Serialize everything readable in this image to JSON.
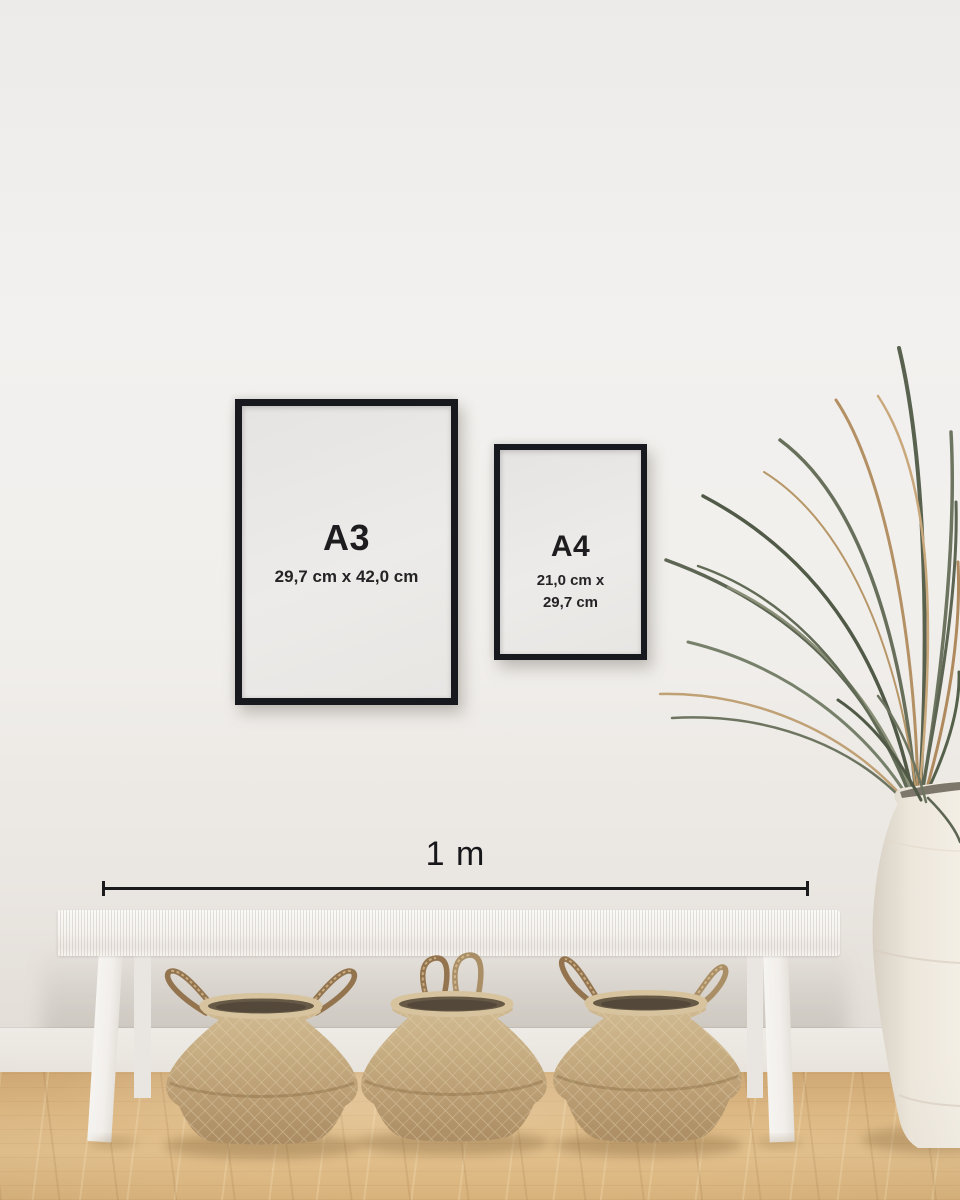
{
  "frames": {
    "a3": {
      "label": "A3",
      "dimensions": "29,7 cm x 42,0 cm"
    },
    "a4": {
      "label": "A4",
      "dimensions_line1": "21,0 cm x",
      "dimensions_line2": "29,7 cm"
    }
  },
  "scale": {
    "label": "1 m"
  },
  "colors": {
    "frame": "#17191f",
    "paper": "#eae8e6",
    "text": "#1d1d1f",
    "wall": "#f0eeec",
    "baseboard": "#ebe8e2",
    "floor_wood": "#dcb884",
    "bench_white": "#f6f4f1",
    "basket_tan": "#c3a87e",
    "basket_interior": "#5f5443",
    "plant_green": "#5d6553",
    "plant_dried": "#b39165",
    "vase_white": "#ece6db"
  }
}
